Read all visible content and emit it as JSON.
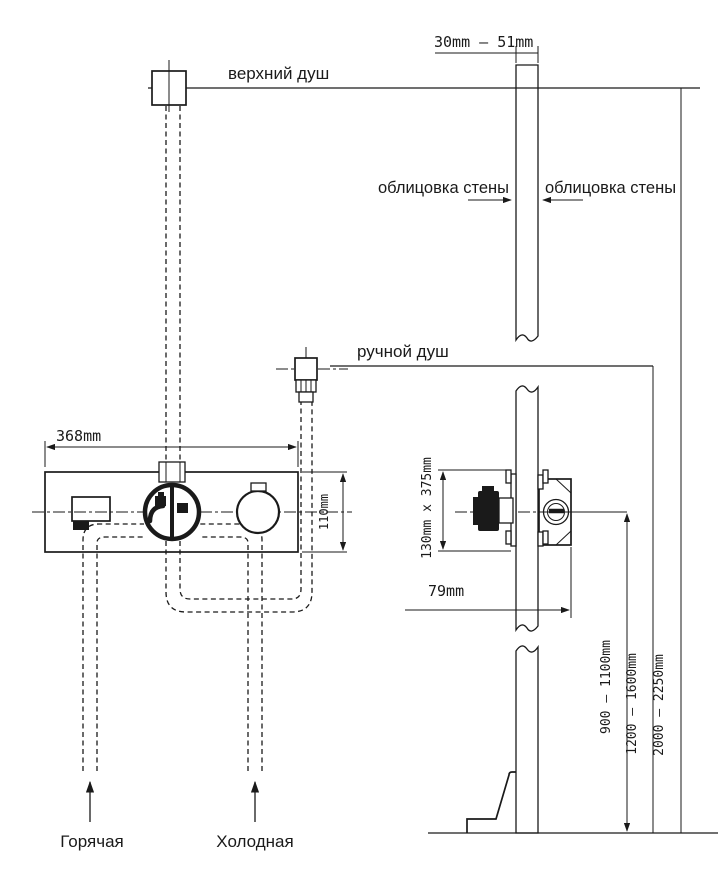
{
  "labels": {
    "overhead_shower": "верхний душ",
    "hand_shower": "ручной душ",
    "wall_cladding_left": "облицовка стены",
    "wall_cladding_right": "облицовка стены",
    "hot_supply": "Горячая",
    "cold_supply": "Холодная"
  },
  "dimensions": {
    "wall_cladding_thickness_range": "30mm — 51mm",
    "mixer_body_width": "368mm",
    "mixer_body_height": "110mm",
    "recess_size": "130mm x 375mm",
    "recess_depth": "79mm",
    "mixer_mount_height_range": "900 — 1100mm",
    "hand_shower_mount_height_range": "1200 — 1600mm",
    "overhead_shower_mount_height_range": "2000 — 2250mm"
  },
  "colors": {
    "line": "#1a1a1a",
    "background": "#ffffff"
  }
}
